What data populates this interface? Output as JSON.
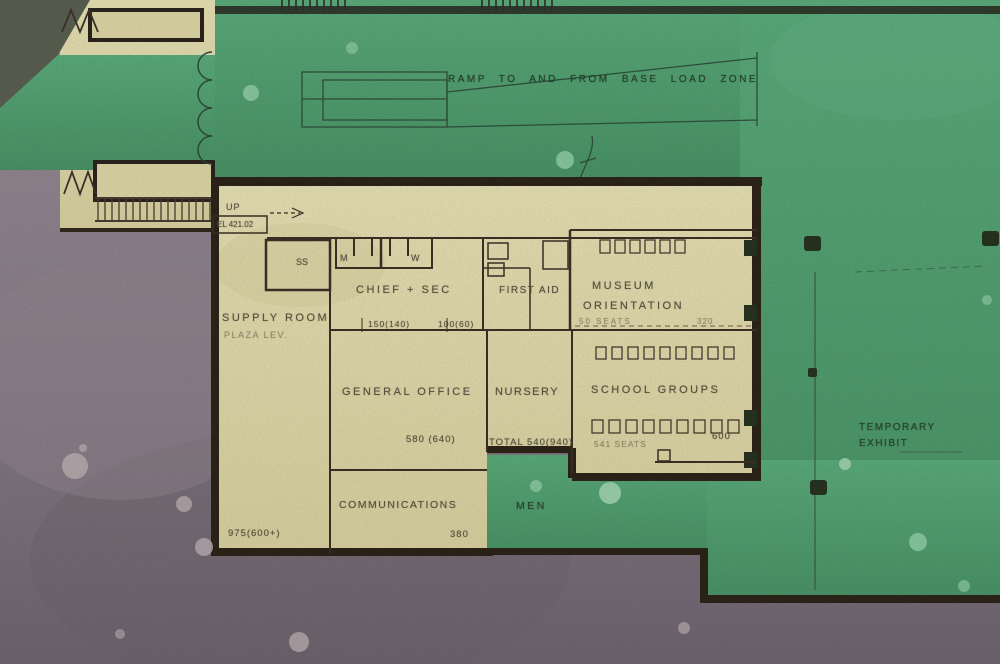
{
  "plan": {
    "title": "Plaza level floor plan",
    "ramp_label": "RAMP TO AND FROM BASE LOAD ZONE",
    "stair": {
      "up": "UP",
      "elevation": "EL 421.02"
    },
    "rooms": {
      "supply": {
        "name": "SUPPLY ROOM",
        "sub": "PLAZA LEV.",
        "total": "975(600+)"
      },
      "closet": {
        "label": "SS"
      },
      "toilets": {
        "m": "M",
        "w": "W"
      },
      "chief_sec": {
        "name": "CHIEF + SEC",
        "area_left": "150(140)",
        "area_right": "100(60)"
      },
      "first_aid": {
        "name": "FIRST AID"
      },
      "museum_orientation": {
        "name_line1": "MUSEUM",
        "name_line2": "ORIENTATION",
        "seats": "50 SEATS",
        "area": "320"
      },
      "general_office": {
        "name": "GENERAL OFFICE",
        "area": "580 (640)"
      },
      "nursery": {
        "name": "NURSERY",
        "total": "TOTAL 540(940)"
      },
      "school_groups": {
        "name": "SCHOOL GROUPS",
        "seats": "541 SEATS",
        "area": "600"
      },
      "communications": {
        "name": "COMMUNICATIONS",
        "area": "380"
      },
      "men": {
        "name": "MEN"
      },
      "temporary_exhibit": {
        "name_line1": "TEMPORARY",
        "name_line2": "EXHIBIT"
      }
    },
    "colors": {
      "green": "#4f9d6f",
      "cream": "#ded8a9",
      "ground": "#877c85",
      "wall": "#2e251b"
    }
  }
}
